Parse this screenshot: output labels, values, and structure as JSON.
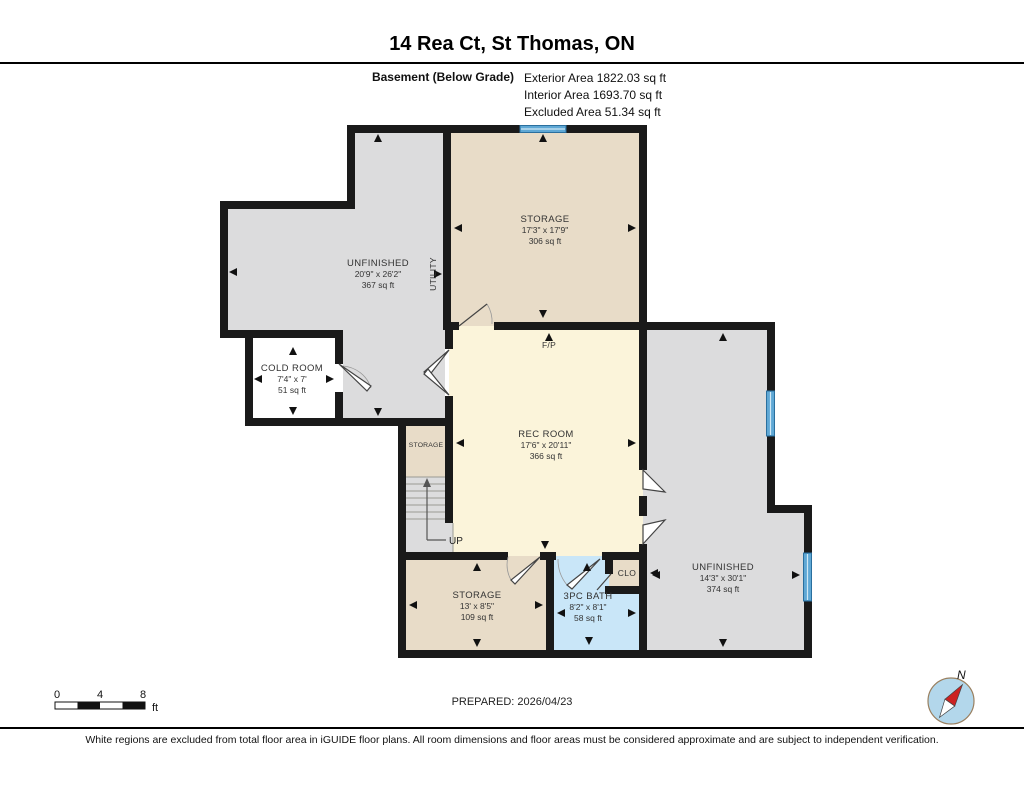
{
  "header": {
    "title": "14 Rea Ct, St Thomas, ON",
    "floor_label": "Basement (Below Grade)",
    "stats": [
      "Exterior Area 1822.03 sq ft",
      "Interior Area 1693.70 sq ft",
      "Excluded Area 51.34 sq ft"
    ]
  },
  "rooms": {
    "storage_top": {
      "name": "STORAGE",
      "dims": "17'3\" x 17'9\"",
      "area": "306 sq ft"
    },
    "unfinished_left": {
      "name": "UNFINISHED",
      "dims": "20'9\" x 26'2\"",
      "area": "367 sq ft"
    },
    "utility": {
      "name": "UTILITY"
    },
    "cold_room": {
      "name": "COLD ROOM",
      "dims": "7'4\" x 7'",
      "area": "51 sq ft"
    },
    "rec_room": {
      "name": "REC ROOM",
      "dims": "17'6\" x 20'11\"",
      "area": "366 sq ft"
    },
    "storage_small": {
      "name": "STORAGE"
    },
    "storage_bottom": {
      "name": "STORAGE",
      "dims": "13' x 8'5\"",
      "area": "109 sq ft"
    },
    "bath": {
      "name": "3PC BATH",
      "dims": "8'2\" x 8'1\"",
      "area": "58 sq ft"
    },
    "unfinished_right": {
      "name": "UNFINISHED",
      "dims": "14'3\" x 30'1\"",
      "area": "374 sq ft"
    },
    "closet": {
      "name": "CLO"
    },
    "fireplace": {
      "label": "F/P"
    },
    "stairs": {
      "label": "UP"
    }
  },
  "scale_bar": {
    "ticks": [
      "0",
      "4",
      "8"
    ],
    "unit": "ft"
  },
  "compass": {
    "north_label": "N"
  },
  "footer": {
    "prepared": "PREPARED: 2026/04/23",
    "disclaimer": "White regions are excluded from total floor area in iGUIDE floor plans. All room dimensions and floor areas must be considered approximate and are subject to independent verification."
  },
  "colors": {
    "wall": "#1a1a1a",
    "finished_beige": "#e8dcc8",
    "unfinished_gray": "#dcdcdd",
    "rec_cream": "#fbf4da",
    "bath_blue": "#c9e6f8",
    "window_blue": "#5fa8d5",
    "excluded_white": "#ffffff",
    "compass_red": "#cc2222"
  }
}
